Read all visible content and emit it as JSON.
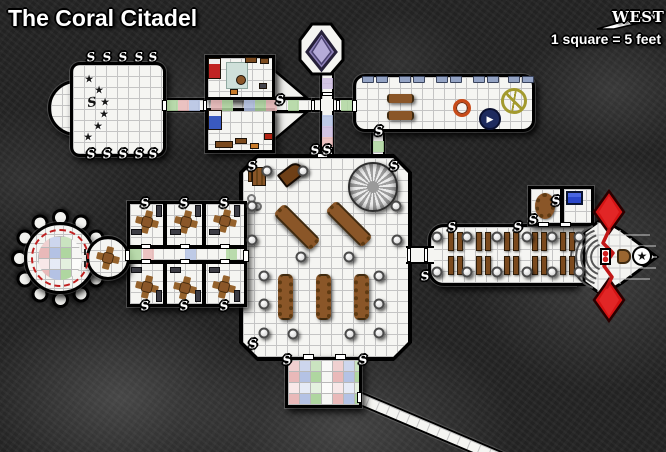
{
  "title": "The Coral Citadel",
  "compass": {
    "direction": "WEST"
  },
  "scale_label": "1 square = 5 feet",
  "markers": {
    "secret_door": "S",
    "star": "★",
    "play": "▶"
  },
  "colors": {
    "rock": "#242424",
    "floor": "#f5f5f2",
    "wall": "#000000",
    "wood": "#8a5628",
    "tile_pink": "#e9b9b9",
    "tile_blue": "#b4c2e4",
    "tile_green": "#afd6a0",
    "tile_violet": "#cbbbdf",
    "crystal_purple": "#8d80b8",
    "crystal_red": "#d31414",
    "bench_blue": "#93a3c4",
    "ring_orange": "#c84a18",
    "disc_navy": "#1d2a5e",
    "wheel_olive": "#a39a2e",
    "stitch_red": "#c02020"
  }
}
